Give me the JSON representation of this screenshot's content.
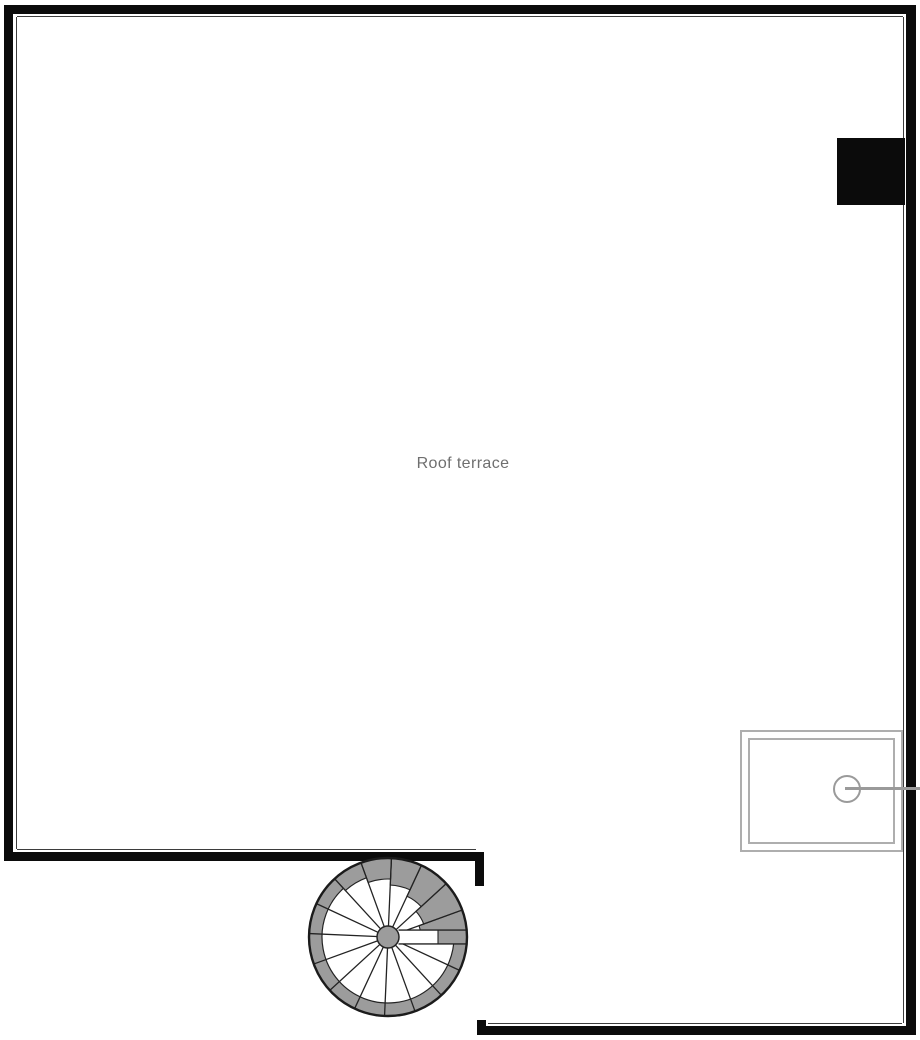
{
  "plan": {
    "room_label": "Roof terrace",
    "elements": {
      "staircase": "spiral-staircase",
      "flue": "chimney-flue-block",
      "skylight": "roof-window-hatch"
    },
    "colors": {
      "background": "#ffffff",
      "wall": "#0b0b0b",
      "inner_line": "#3d3d3d",
      "stair_fill": "#9c9c9c",
      "stair_stroke": "#232323",
      "fixture_stroke": "#aeaeae",
      "fixture_rod": "#9a9a9a",
      "label_text": "#6f6f6f"
    }
  }
}
